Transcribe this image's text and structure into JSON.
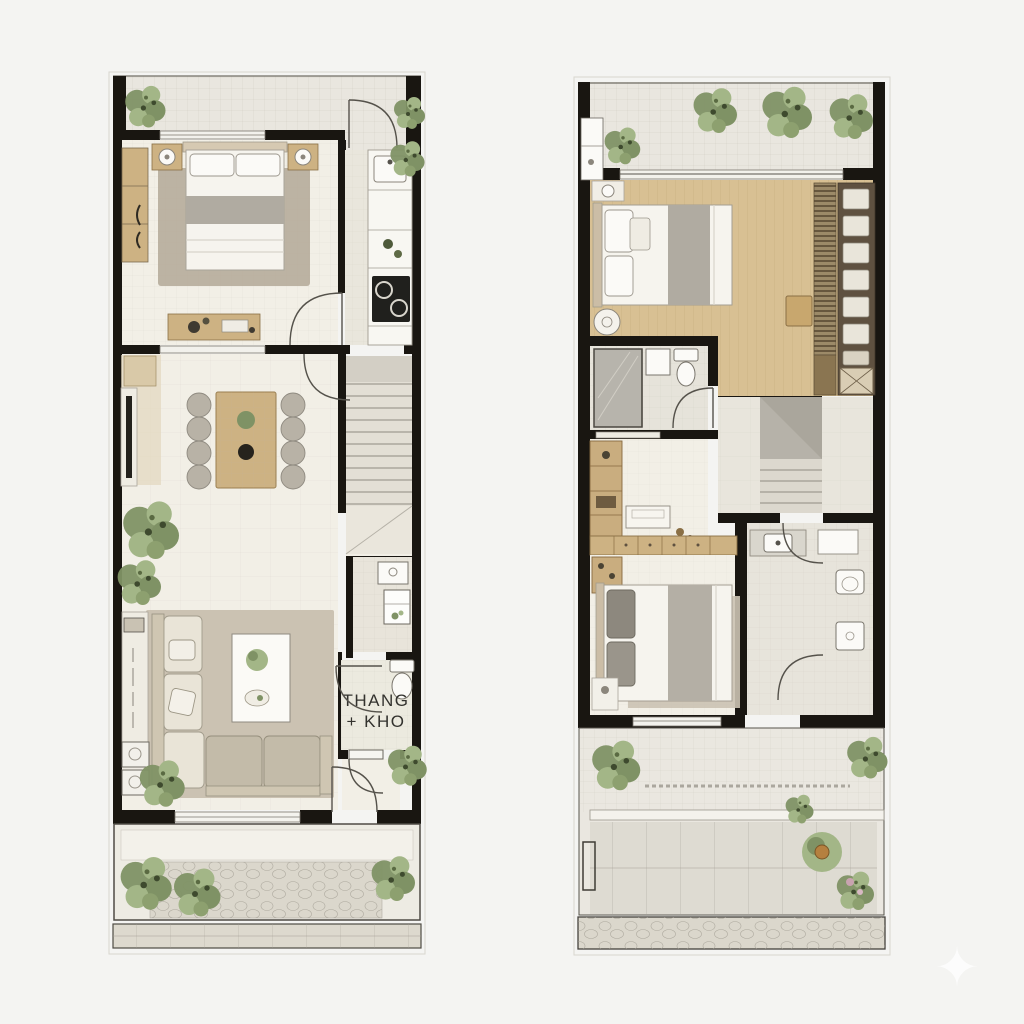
{
  "page": {
    "background": "#f4f4f2"
  },
  "labels": {
    "stairs_storage_line1": "THANG",
    "stairs_storage_line2": "+ KHO"
  },
  "icons": {
    "sparkle": "✦"
  },
  "colors": {
    "bg": "#f4f4f2",
    "wall": "#191611",
    "floor": "#f2efe6",
    "floor_alt": "#e9e6dc",
    "tile": "#e9e6df",
    "wood_floor": "#d8c093",
    "wood_furniture": "#cdb283",
    "wood_dark": "#5f5140",
    "stone": "#dbd7cc",
    "plant_green": "#7f9265",
    "plant_light": "#a3b687",
    "rug": "#b3a897",
    "rug_light": "#cbc2b2",
    "fabric_gray": "#b0aba1",
    "fixture_white": "#fbfaf7",
    "line_gray": "#8b867c",
    "label_text": "#33322e"
  }
}
